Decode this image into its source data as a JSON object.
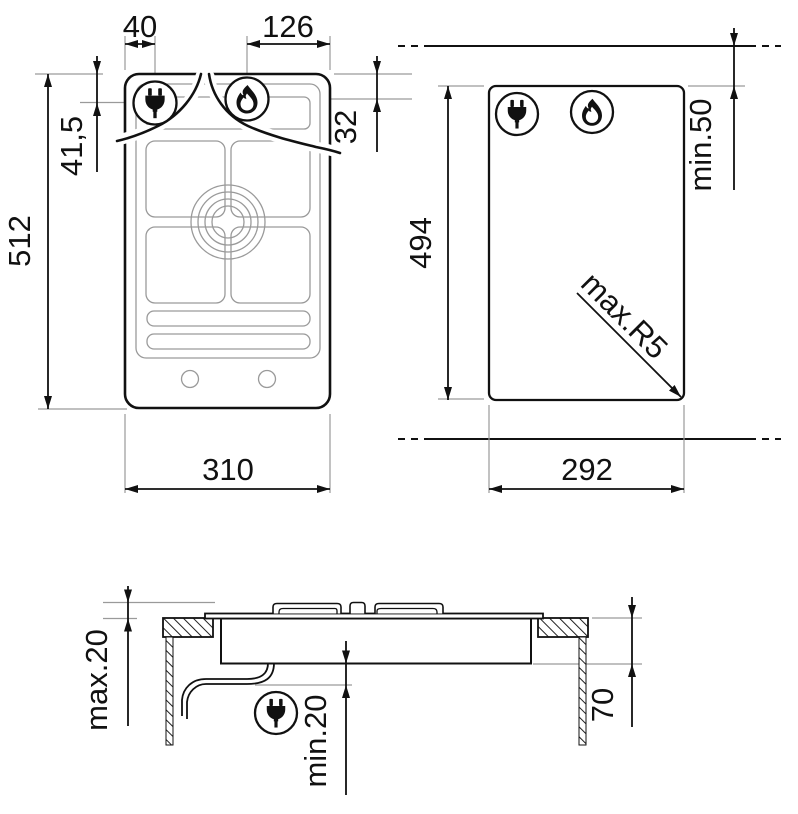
{
  "diagram": {
    "description": "gas hob installation drawing",
    "hob_top_view": {
      "icons": [
        "power-plug",
        "gas-flame"
      ],
      "dimensions": {
        "plug_offset_x": "40",
        "flame_offset_x": "126",
        "overall_height": "512",
        "plug_offset_y": "41,5",
        "flame_offset_y": "32",
        "overall_width": "310"
      }
    },
    "cutout_view": {
      "icons": [
        "power-plug",
        "gas-flame"
      ],
      "dimensions": {
        "cutout_height": "494",
        "rear_clearance": "min.50",
        "corner_radius": "max.R5",
        "cutout_width": "292"
      }
    },
    "section_view": {
      "icons": [
        "power-plug"
      ],
      "dimensions": {
        "protrusion_above_worktop": "max.20",
        "clearance_below_hob": "min.20",
        "depth_below_worktop": "70"
      }
    }
  }
}
